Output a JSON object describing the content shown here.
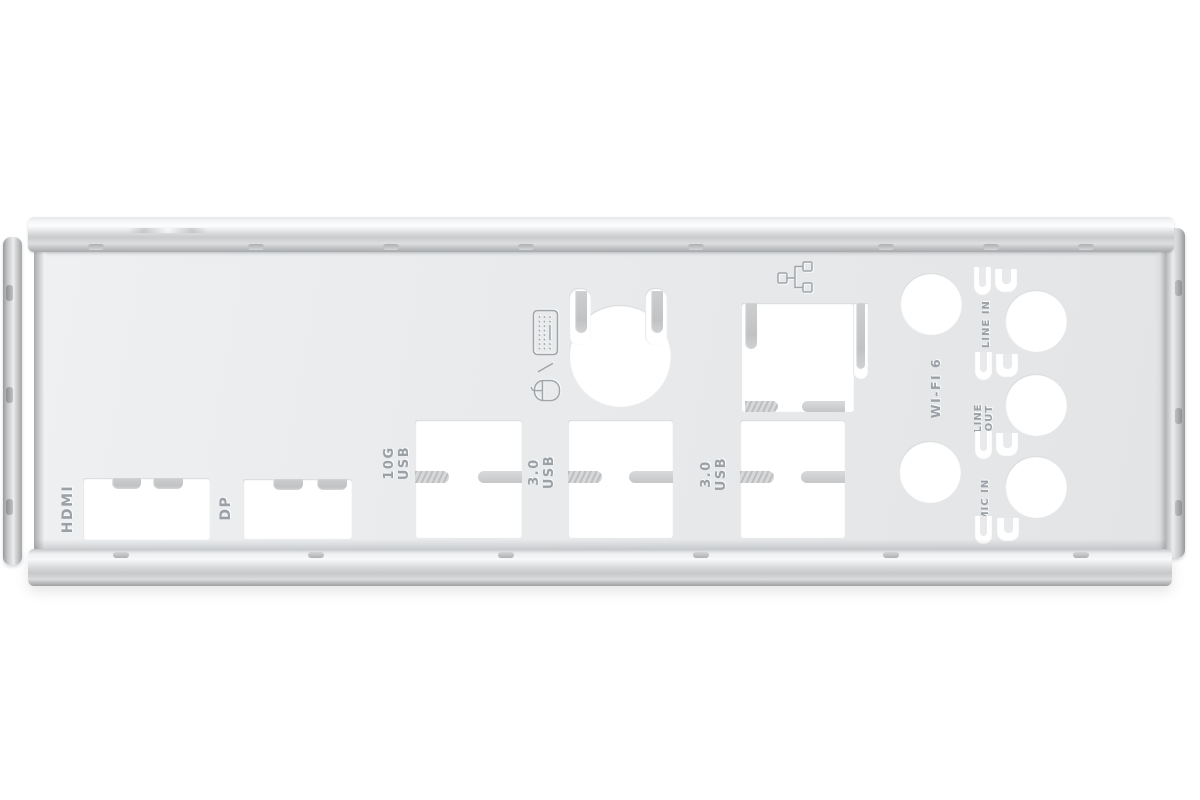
{
  "title": "Motherboard rear I/O shield backplate",
  "colors": {
    "background": "#ffffff",
    "plate": "#e8eaec",
    "metal_highlight": "#f8f9fa",
    "metal_shadow": "#a8aaac",
    "engraving": "#9aa0a5",
    "cutout": "#ffffff"
  },
  "engravings": {
    "hdmi": "HDMI",
    "dp": "DP",
    "usb_10g": {
      "line1": "10G",
      "line2": "USB"
    },
    "usb_30_a": {
      "line1": "3.0",
      "line2": "USB"
    },
    "usb_30_b": {
      "line1": "3.0",
      "line2": "USB"
    },
    "wifi": "WI-FI 6",
    "line_in": "LINE IN",
    "line_out": {
      "line1": "LINE",
      "line2": "OUT"
    },
    "mic_in": "MIC IN",
    "ps2_separator": "/"
  },
  "icons": {
    "keyboard": "keyboard-icon",
    "mouse": "mouse-icon",
    "separator": "slash-separator-icon",
    "ethernet": "ethernet-icon"
  },
  "cutout_counts": {
    "wifi_antenna_holes": 2,
    "audio_jack_holes": 3,
    "u_ground_clips": 8
  }
}
